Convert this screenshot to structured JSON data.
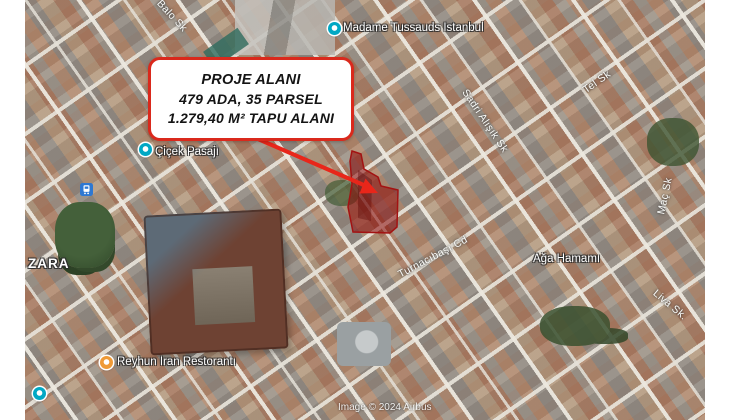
{
  "callout": {
    "line1": "PROJE ALANI",
    "line2": "479 ADA, 35 PARSEL",
    "line3": "1.279,40 M² TAPU ALANI",
    "border_color": "#da291c"
  },
  "map": {
    "attribution": "Image © 2024 Airbus",
    "poi_labels": [
      {
        "id": "madame-tussauds",
        "text": "Madame Tussauds Istanbul"
      },
      {
        "id": "cicek-pasaji",
        "text": "Çiçek Pasajı"
      },
      {
        "id": "zara",
        "text": "ZARA"
      },
      {
        "id": "reyhun-iran-restoranti",
        "text": "Reyhun Iran Restorantı"
      },
      {
        "id": "aga-hamami",
        "text": "Ağa Hamamı"
      }
    ],
    "street_labels": [
      {
        "id": "balo-sk",
        "text": "Balo Sk"
      },
      {
        "id": "sadri-alisik-sk",
        "text": "Sadri Alışık Sk"
      },
      {
        "id": "tel-sk",
        "text": "Tel Sk"
      },
      {
        "id": "mac-sk",
        "text": "Maç Sk"
      },
      {
        "id": "turnacibasi-cd",
        "text": "Turnacıbaşı Cd"
      },
      {
        "id": "liva-sk",
        "text": "Liva Sk."
      }
    ],
    "icons": {
      "attraction_pin": "#01a8c4",
      "camera_pin": "#01a8c4",
      "restaurant_pin": "#ef9a37",
      "place_pin": "#01a8c4",
      "transit_station": "#2e78d2"
    },
    "highlight": {
      "parcel_fill": "#8b0a0a",
      "parcel_stroke": "#a31212",
      "arrow_color": "#e8261a"
    }
  }
}
